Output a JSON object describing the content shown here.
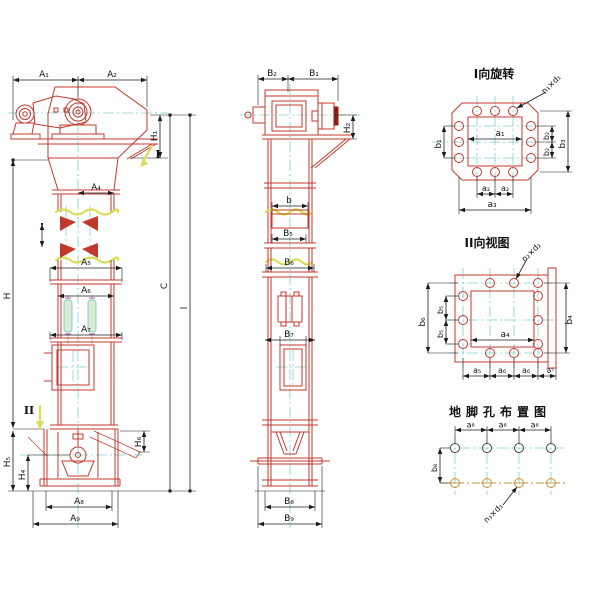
{
  "drawing": {
    "kind": "bucket-elevator outline drawing",
    "colors": {
      "outline_red": "#c0392b",
      "centerline_cyan": "#7fcfcf",
      "dimension_black": "#1c1c1c",
      "break_yellow": "#d9dd55",
      "anchor_orange": "#c8903c",
      "background": "#ffffff"
    },
    "front_view": {
      "marker_top": "I",
      "marker_bottom": "II",
      "dims": {
        "A1": "A₁",
        "A2": "A₂",
        "A4": "A₄",
        "A5": "A₅",
        "A6": "A₆",
        "A7": "A₇",
        "A8": "A₈",
        "A9": "A₉",
        "H": "H",
        "H1": "H₁",
        "H4": "H₄",
        "H5": "H₅",
        "H6": "H₆",
        "C": "C",
        "l": "l"
      }
    },
    "side_view": {
      "dims": {
        "B1": "B₁",
        "B2": "B₂",
        "B5": "B₅",
        "B6": "B₆",
        "B7": "B₇",
        "B8": "B₈",
        "B9": "B₉",
        "H2": "H₂",
        "b": "b"
      }
    },
    "view_I": {
      "title": "I向旋转",
      "hole_callout": "n₁×d₁",
      "dims": {
        "a1": "a₁",
        "a2": "a₂",
        "a3": "a₃",
        "b1": "b₁",
        "b2": "b₂",
        "b3": "b₃"
      }
    },
    "view_II": {
      "title": "II向视图",
      "hole_callout": "n₂×d₂",
      "dims": {
        "a4": "a₄",
        "a5": "a₅",
        "a6": "a₆",
        "a7": "a₇",
        "b4": "b₄",
        "b5": "b₅",
        "b6": "b₆"
      }
    },
    "anchor_plan": {
      "title": "地脚孔布置图",
      "hole_callout": "n₃×d₃",
      "dims": {
        "a8": "a₈",
        "b8": "b₈"
      }
    }
  }
}
